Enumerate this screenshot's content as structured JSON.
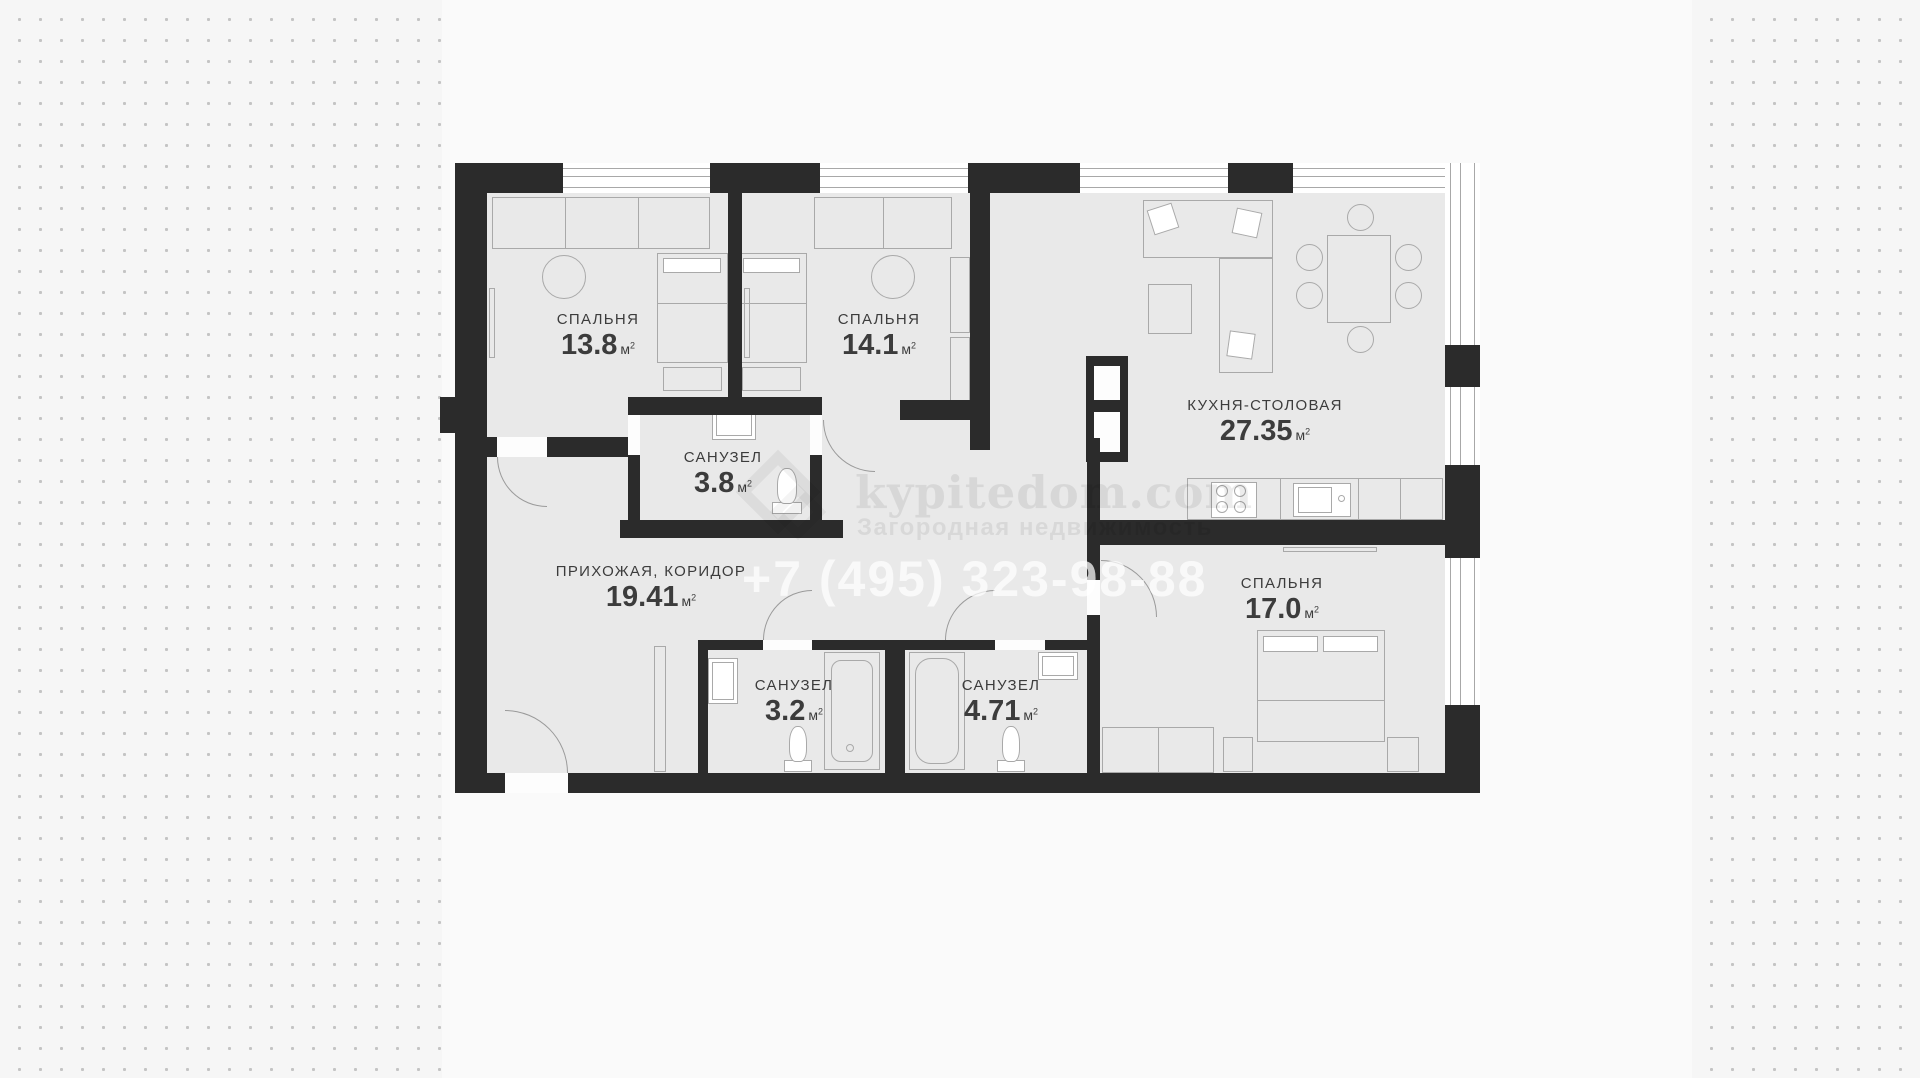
{
  "palette": {
    "page_background": "#f7f7f7",
    "dot_color": "#c4c4c4",
    "wall_color": "#2b2b2b",
    "floor_color": "#e9e9e9",
    "furniture_line_color": "#a9a9a9",
    "label_color": "#3c3c3c"
  },
  "units": {
    "m": "м",
    "sup": "2"
  },
  "rooms": [
    {
      "id": "bedroom-13",
      "name": "СПАЛЬНЯ",
      "area": "13.8"
    },
    {
      "id": "bedroom-14",
      "name": "СПАЛЬНЯ",
      "area": "14.1"
    },
    {
      "id": "kitchen-dining",
      "name": "КУХНЯ-СТОЛОВАЯ",
      "area": "27.35"
    },
    {
      "id": "bathroom-38",
      "name": "САНУЗЕЛ",
      "area": "3.8"
    },
    {
      "id": "hallway",
      "name": "ПРИХОЖАЯ, КОРИДОР",
      "area": "19.41"
    },
    {
      "id": "bathroom-32",
      "name": "САНУЗЕЛ",
      "area": "3.2"
    },
    {
      "id": "bathroom-471",
      "name": "САНУЗЕЛ",
      "area": "4.71"
    },
    {
      "id": "bedroom-17",
      "name": "СПАЛЬНЯ",
      "area": "17.0"
    }
  ],
  "watermark": {
    "brand": "kypitedom.com",
    "tagline": "Загородная недвижимость",
    "phone": "+7 (495) 323-98-88"
  }
}
